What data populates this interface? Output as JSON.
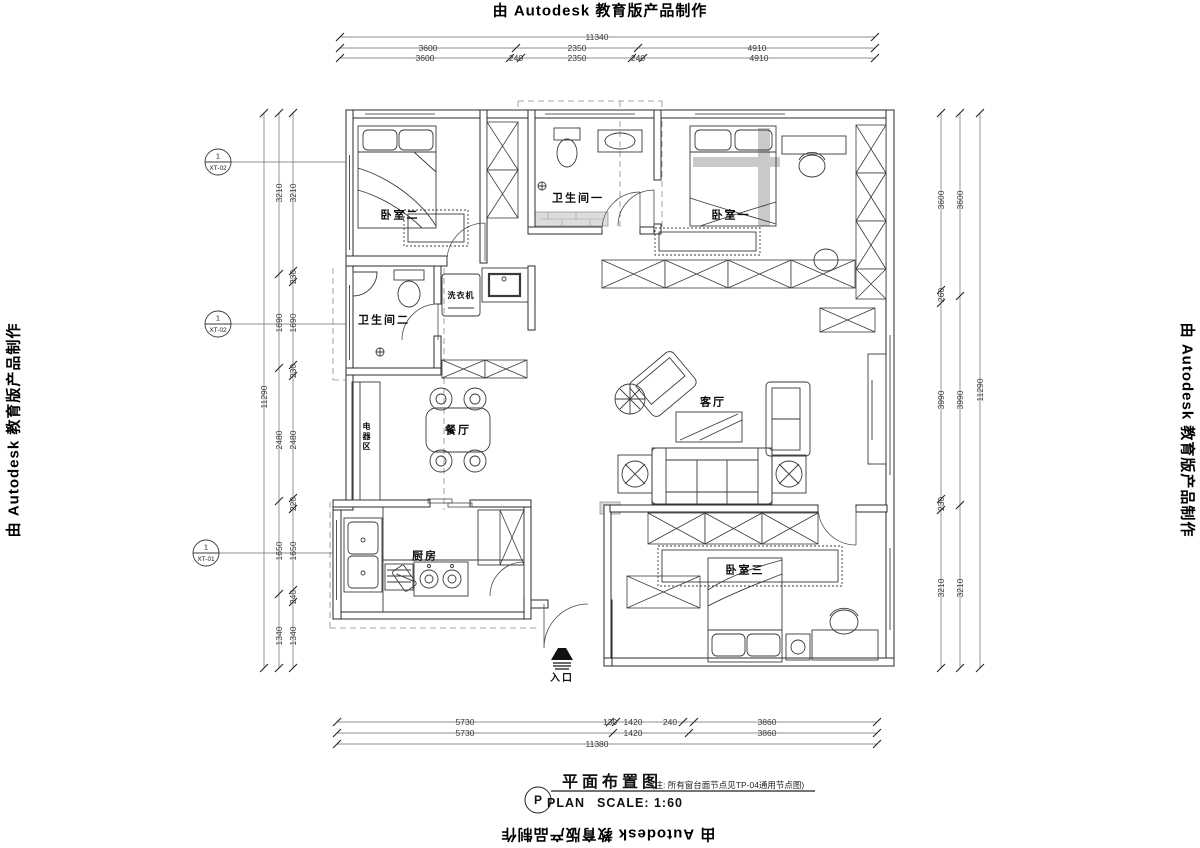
{
  "banner": {
    "text": "由 Autodesk 教育版产品制作"
  },
  "title_block": {
    "bubble": "P",
    "plan_word": "PLAN",
    "title": "平面布置图",
    "note": "(注: 所有窗台面节点见TP-04通用节点图)",
    "scale": "SCALE: 1:60"
  },
  "rooms": {
    "bedroom2": "卧室二",
    "bath1": "卫生间一",
    "bedroom1": "卧室一",
    "bath2": "卫生间二",
    "washer": "洗衣机",
    "appliance": "电器区",
    "dining": "餐厅",
    "living": "客厅",
    "kitchen": "厨房",
    "bedroom3": "卧室三",
    "entrance": "入口"
  },
  "callouts": {
    "c1": {
      "num": "1",
      "code": "XT-02"
    },
    "c2": {
      "num": "1",
      "code": "XT-02"
    },
    "c3": {
      "num": "1",
      "code": "XT-01"
    }
  },
  "dims": {
    "top": {
      "total": "11340",
      "coarse": [
        "3600",
        "2350",
        "4910"
      ],
      "fine": [
        "3600",
        "240",
        "2350",
        "240",
        "4910"
      ]
    },
    "bottom": {
      "total": "11380",
      "coarse": [
        "5730",
        "1420",
        "3860"
      ],
      "fine": [
        "5730",
        "130",
        "1420",
        "240",
        "3860"
      ]
    },
    "left": {
      "total": "11290",
      "coarse": [
        "3210",
        "1690",
        "2480",
        "1650",
        "1340"
      ],
      "fine": [
        "3210",
        "230",
        "1690",
        "230",
        "2480",
        "220",
        "1650",
        "240",
        "1340"
      ]
    },
    "right": {
      "total": "11290",
      "coarse": [
        "3600",
        "3990",
        "3210"
      ],
      "fine": [
        "3600",
        "260",
        "3990",
        "230",
        "3210"
      ]
    }
  }
}
